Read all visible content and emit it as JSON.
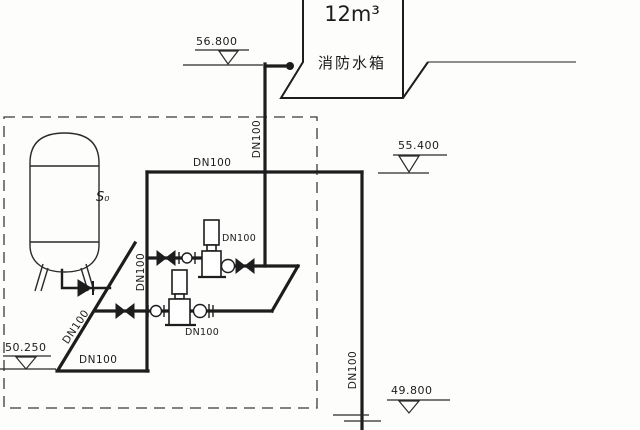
{
  "diagram": {
    "tank": {
      "volume": "12m³",
      "name": "消防水箱"
    },
    "vessel_label": "S₀",
    "elevations": {
      "tank_inlet": "56.800",
      "main_pipe": "55.400",
      "floor": "50.250",
      "riser_bottom": "49.800"
    },
    "pipe_labels": {
      "top_main": "DN100",
      "tank_riser": "DN100",
      "right_riser": "DN100",
      "suction_header": "DN100",
      "diagonal_suction": "DN100",
      "upper_pump": "DN100",
      "lower_pump": "DN100",
      "bottom_pipe": "DN100"
    },
    "colors": {
      "line": "#1d1d1d",
      "thin_line": "#2e2e2e",
      "background": "#fdfdfc"
    }
  }
}
